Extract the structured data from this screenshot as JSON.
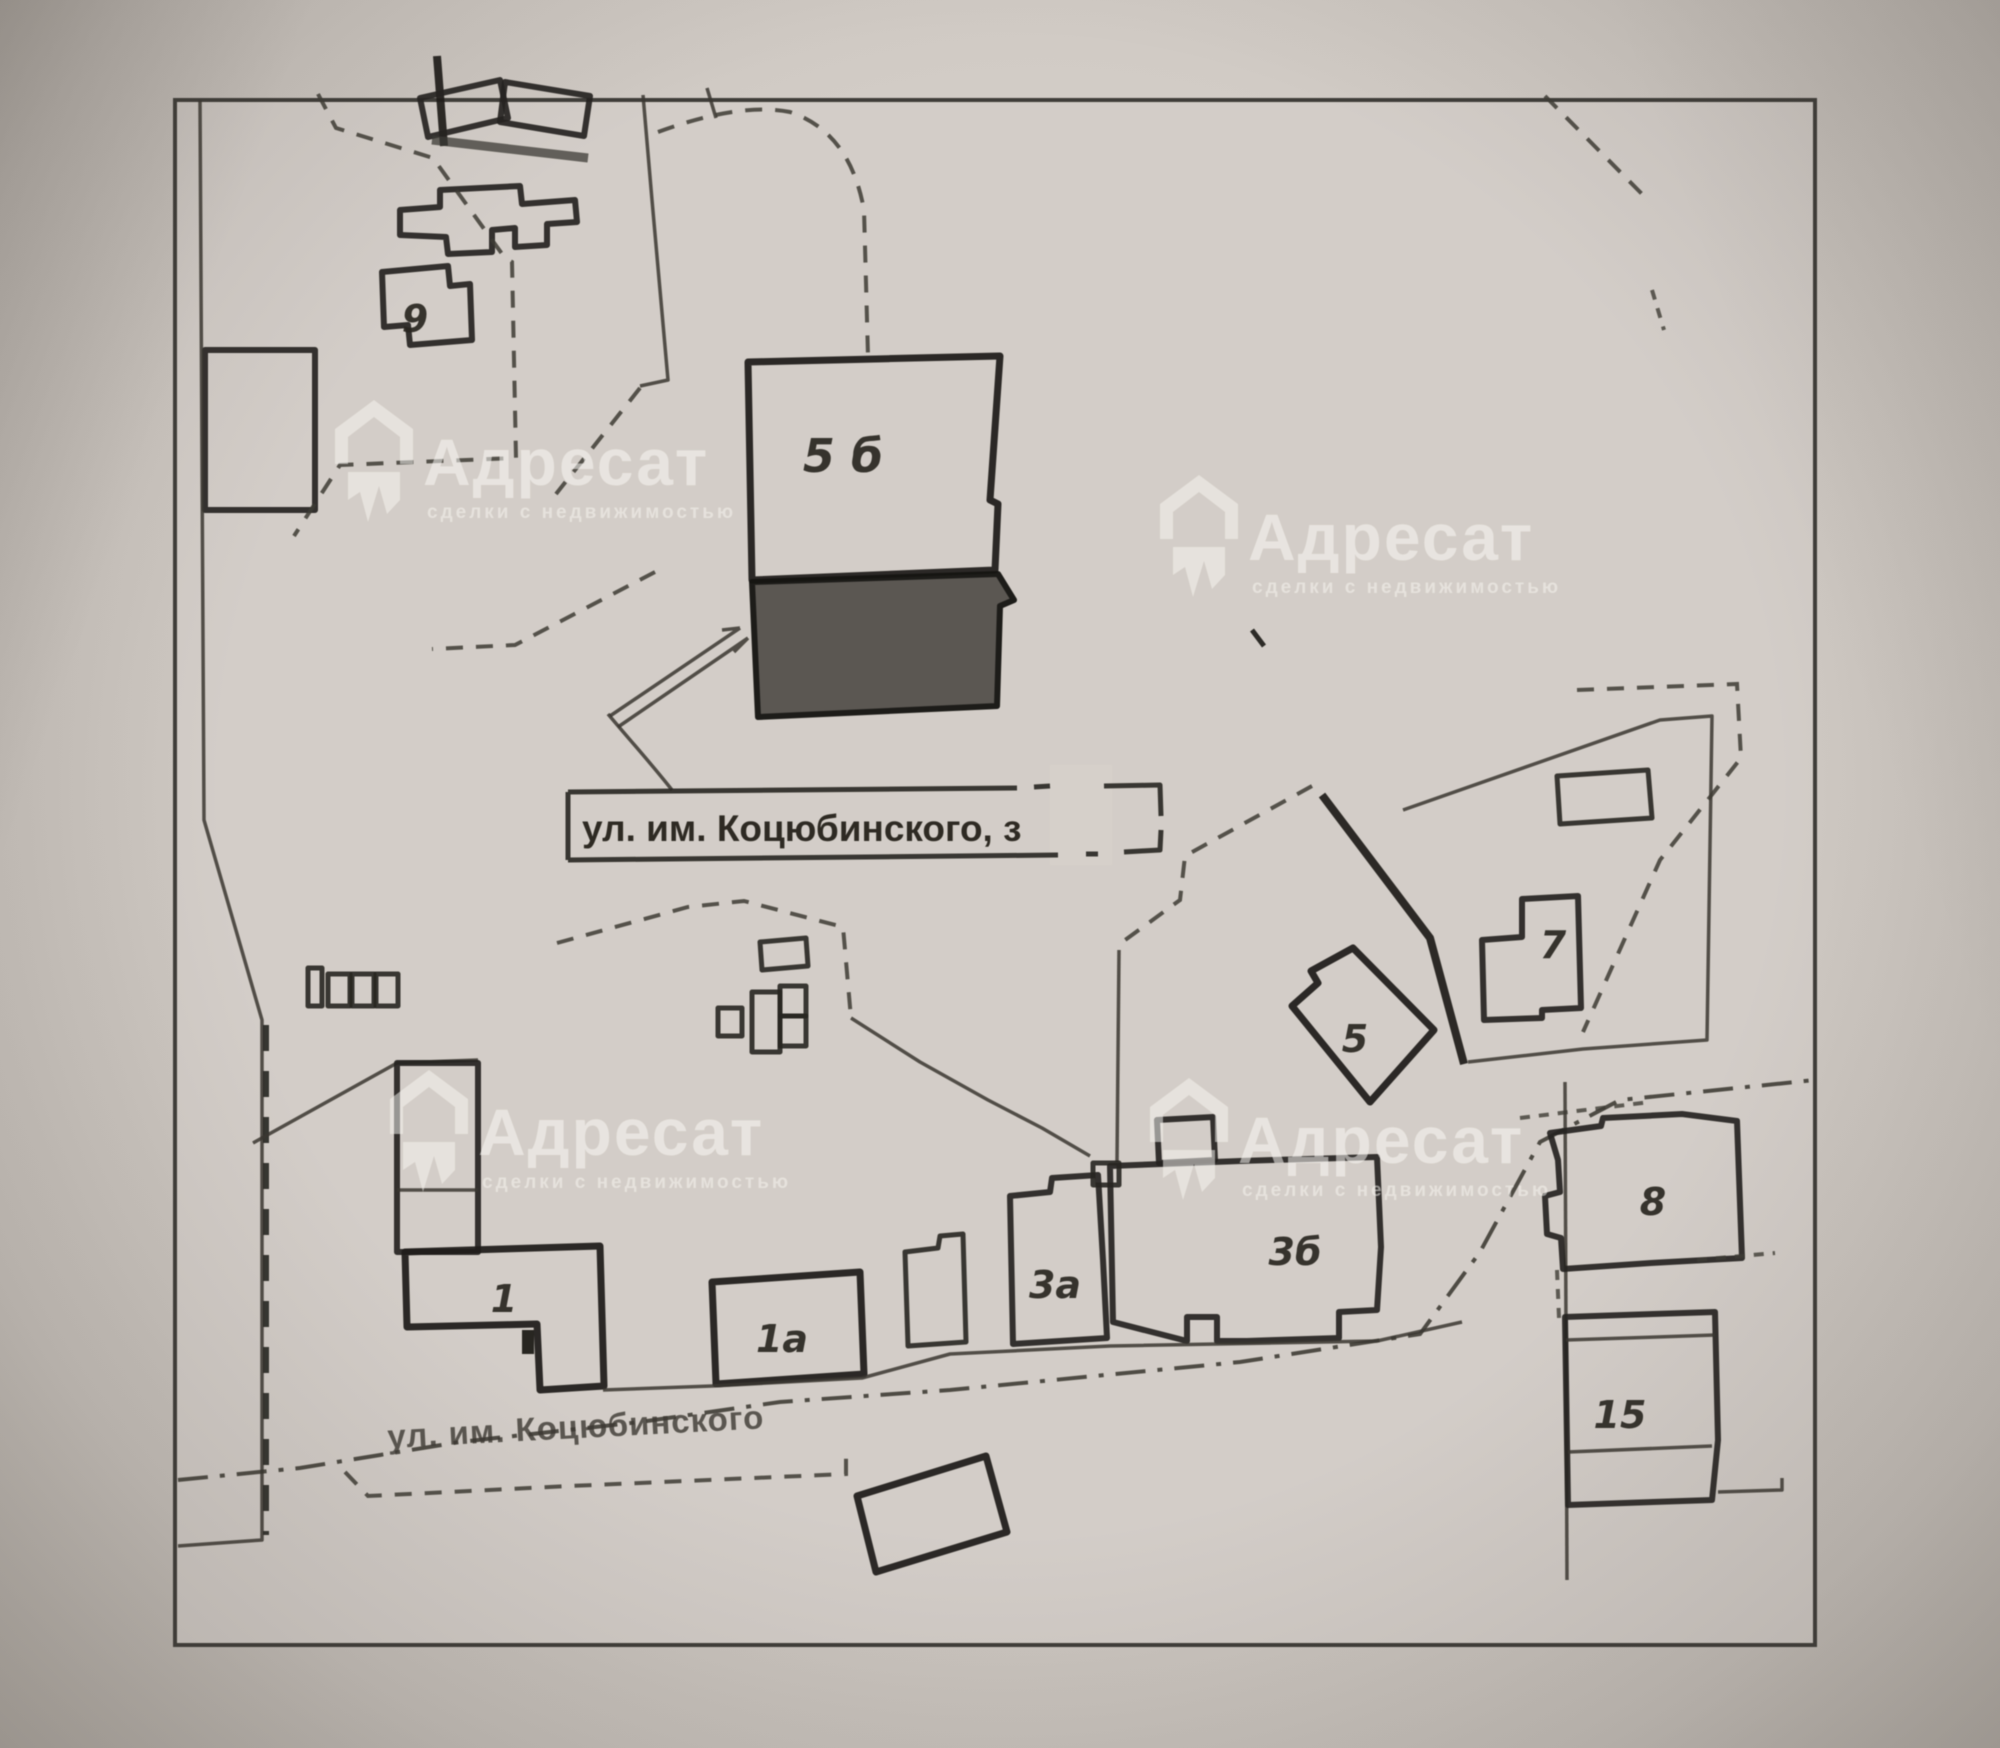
{
  "map": {
    "kind": "scanned cadastral site plan photo",
    "street_label": "ул. им. Коцюбинского",
    "annotation": {
      "text": "ул. им. Коцюбинского, з",
      "note": "house number partially erased / whited out"
    },
    "buildings": [
      {
        "id": "9",
        "label": "9"
      },
      {
        "id": "5b",
        "label": "5 б"
      },
      {
        "id": "1",
        "label": "1"
      },
      {
        "id": "1a",
        "label": "1а"
      },
      {
        "id": "3a",
        "label": "3а"
      },
      {
        "id": "3b",
        "label": "3б"
      },
      {
        "id": "5",
        "label": "5"
      },
      {
        "id": "7",
        "label": "7"
      },
      {
        "id": "8",
        "label": "8"
      },
      {
        "id": "15",
        "label": "15"
      }
    ],
    "highlight": {
      "description": "dark shaded building south of 5б",
      "fill": "#56524d"
    },
    "watermark": {
      "brand": "Адресат",
      "tagline": "сделки с недвижимостью",
      "count": 4
    },
    "colors": {
      "paper": "#d2ccc6",
      "ink": "#23211e",
      "frame": "#3e3c38"
    }
  }
}
